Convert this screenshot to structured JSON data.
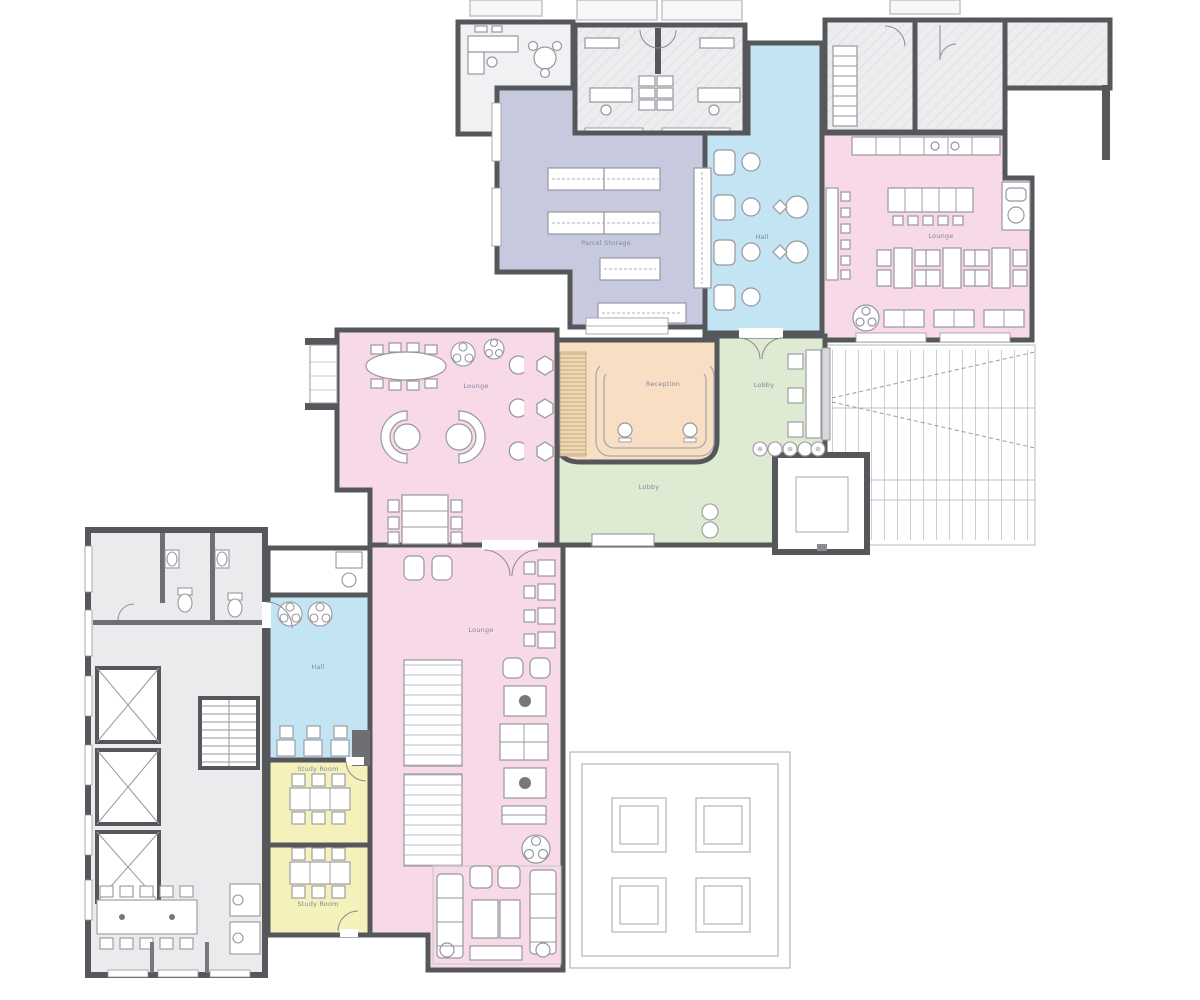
{
  "palette": {
    "wall": "#56575b",
    "pink": "#f8d9e7",
    "lavender": "#c7cade",
    "blue": "#c2e4f3",
    "green": "#dfead2",
    "orange": "#f8dfc3",
    "yellow": "#f5f1bb",
    "hatch_room": "#ededef",
    "existing_floor": "#ebebed",
    "furniture_line": "#97979f",
    "label_text": "#8187a3"
  },
  "rooms": {
    "parcel_storage": {
      "label": "Parcel Storage"
    },
    "hall_upper": {
      "label": "Hall"
    },
    "lounge_upper": {
      "label": "Lounge"
    },
    "lounge_middle": {
      "label": "Lounge"
    },
    "reception": {
      "label": "Reception"
    },
    "lobby_upper": {
      "label": "Lobby"
    },
    "lobby_lower": {
      "label": "Lobby"
    },
    "hall_lower": {
      "label": "Hall"
    },
    "lounge_lower": {
      "label": "Lounge"
    },
    "study_room_1": {
      "label": "Study Room"
    },
    "study_room_2": {
      "label": "Study Room"
    }
  }
}
